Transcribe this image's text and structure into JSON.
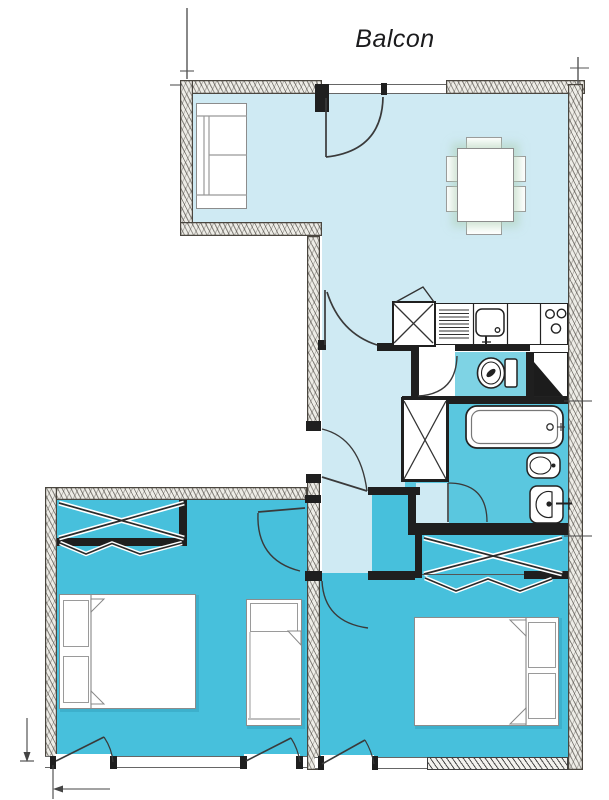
{
  "labels": {
    "balcony": "Balcon"
  },
  "palette": {
    "background": "#ffffff",
    "floor_main": "#cfeaf3",
    "floor_wc": "#7ed3e4",
    "floor_bath": "#5ac7df",
    "floor_bedroom": "#47c0dc",
    "wall_dark": "#1f1f1f",
    "wall_hatch_base": "#edece6",
    "wall_hatch_line": "#4a463f",
    "furniture_outline": "#8c8c8c",
    "fixture_ink": "#2a2a2a",
    "door_ink": "#3a3a3a",
    "label_ink": "#1b1b1d"
  }
}
